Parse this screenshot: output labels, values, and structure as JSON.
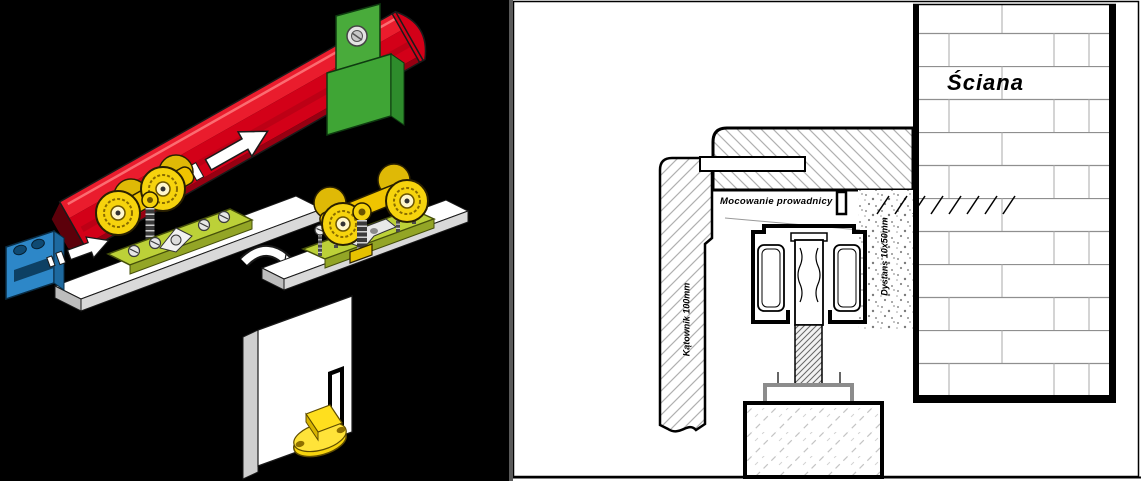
{
  "window": {
    "width_px": 1141,
    "height_px": 481
  },
  "left_panel": {
    "name": "exploded-assembly-illustration",
    "background_color": "#000000",
    "colors": {
      "track": "#d30018",
      "ceiling_bracket": "#3fa535",
      "rollers": "#f6d30d",
      "mounting_plate": "#bcd138",
      "end_stop": "#2d87c8",
      "door": "#ffffff"
    },
    "parts": [
      "track-rail",
      "ceiling-clamp-bracket",
      "twin-roller-carriage",
      "insertion-arrow",
      "end-stop",
      "door-top-mounting-plate",
      "screws",
      "door-panel",
      "floor-guide",
      "transfer-arrow"
    ]
  },
  "right_panel": {
    "name": "installation-cross-section",
    "labels": {
      "wall": "Ściana",
      "guide_mounting": "Mocowanie prowadnicy",
      "angle_bracket": "Kątownik 100mm",
      "spacer": "Dystans 10x50mm"
    }
  }
}
